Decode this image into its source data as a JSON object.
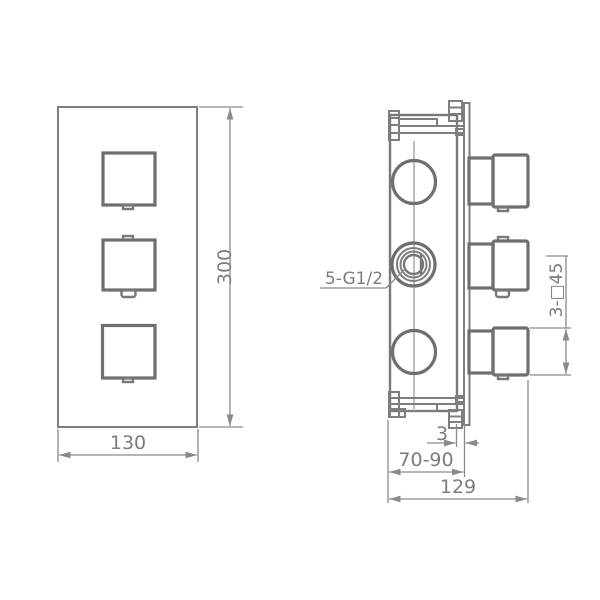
{
  "drawing": {
    "type": "technical-dimension-drawing",
    "views": [
      "front-view",
      "side-view"
    ]
  },
  "dims": {
    "front_width": "130",
    "front_height": "300",
    "connections_label": "5-G1/2",
    "handles_label": "3-□45",
    "plate_gap": "3",
    "install_depth": "70-90",
    "total_depth": "129"
  },
  "colors": {
    "background": "#ffffff",
    "line": "#7e7e7e",
    "line_bold": "#6f6f6f",
    "dimension": "#8a8a8a",
    "text": "#7c7c7c"
  }
}
